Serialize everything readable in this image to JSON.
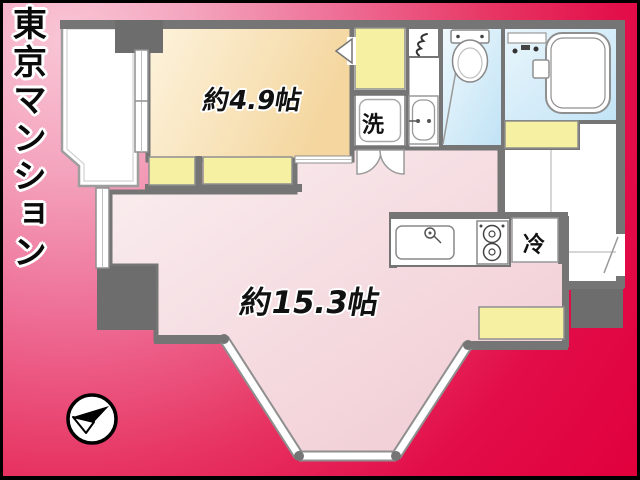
{
  "header": {
    "building_title": "東京マンション"
  },
  "plan": {
    "room_small_label": "約4.9帖",
    "room_large_label": "約15.3帖",
    "washer_label": "洗",
    "fridge_label": "冷"
  },
  "colors": {
    "background_pink": "#f9c6d6",
    "background_red": "#e0003c",
    "wall_gray": "#757575",
    "pillar_gray": "#6d6d6d",
    "closet_yellow": "#f6f1a2",
    "small_room_floor": "#f6d9a4",
    "ldk_floor": "#f2ccd3",
    "wet_area_floor": "#c2e4f6",
    "frame_black": "#000000"
  }
}
